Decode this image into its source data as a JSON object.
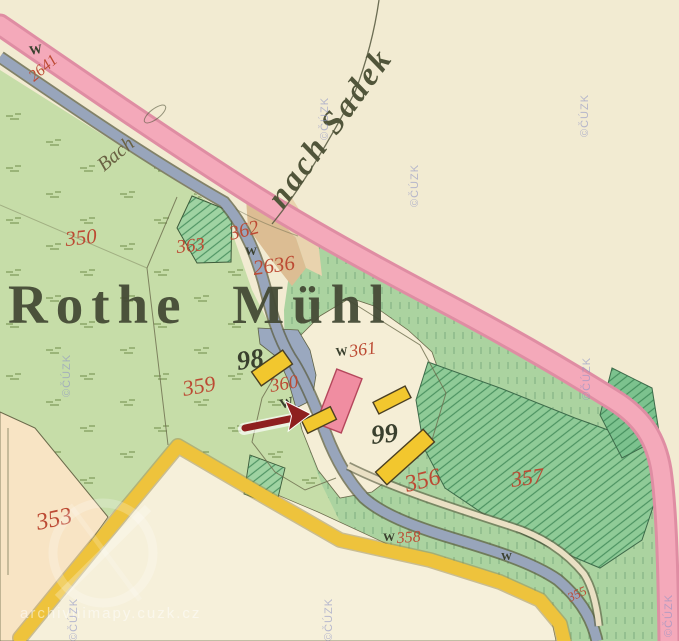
{
  "labels": {
    "place": "Rothe Mühl",
    "direction": "nach Sadek",
    "stream": "Bach"
  },
  "houses": {
    "h98": "98",
    "h99": "99"
  },
  "parcels": {
    "p350": "350",
    "p353": "353",
    "p355": "355",
    "p356": "356",
    "p357": "357",
    "p358": "358",
    "p359": "359",
    "p360": "360",
    "p361": "361",
    "p362": "362",
    "p363": "363",
    "p2636": "2636",
    "road2641": "2641"
  },
  "symbols": {
    "wiese": "W"
  },
  "watermarks": {
    "copyright": "©ČÚZK",
    "site": "archivnimapy.cuzk.cz"
  },
  "annotation": {
    "shape": "red-arrow",
    "color": "#8e1f1f"
  },
  "colors": {
    "paper": "#f2ebd2",
    "field_green": "#c6dda8",
    "meadow_green": "#abd3a0",
    "garden_green": "#8fcb97",
    "water_blue": "#98a5bb",
    "road_pink": "#f4a9ba",
    "road_yellow": "#eec33c",
    "building_yellow": "#f2c72e",
    "building_pink": "#f08da1",
    "parcel_red": "#bc4a33",
    "ink": "#3a402e",
    "arrow_red": "#8e1f1f",
    "watermark_blue": "#8d93c6"
  }
}
